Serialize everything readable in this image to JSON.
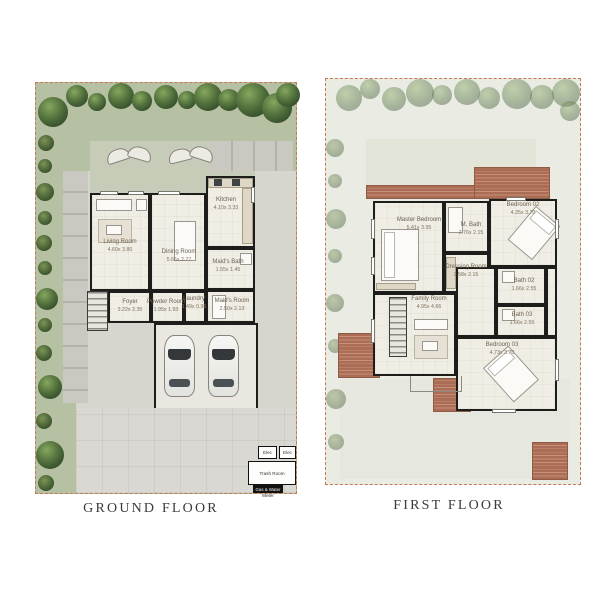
{
  "sheet": {
    "background": "#ffffff"
  },
  "colors": {
    "plan_border": "#c27a54",
    "garden": "#b6c0a2",
    "hardscape": "#d6d5ce",
    "walls": "#1d1d1b",
    "deck": "#ab6d56",
    "faded_background": "#eaece4"
  },
  "plans": [
    {
      "title": "GROUND FLOOR",
      "rooms": [
        {
          "name": "Living Room",
          "dims": "4.60x 3.80"
        },
        {
          "name": "Dining Room",
          "dims": "5.66x 2.77"
        },
        {
          "name": "Kitchen",
          "dims": "4.10x 3.33"
        },
        {
          "name": "Maid's Bath",
          "dims": "1.55x 1.45"
        },
        {
          "name": "Maid's Room",
          "dims": "2.50x 2.13"
        },
        {
          "name": "Foyer",
          "dims": "3.22x 2.35"
        },
        {
          "name": "Powder Room",
          "dims": "1.95x 1.93"
        },
        {
          "name": "Laundry",
          "dims": "1.49x 0.95"
        }
      ],
      "utility": {
        "elec1": "Elec",
        "elec2": "Elec",
        "trash": "Trash Room",
        "meter_line1": "Gas & Water",
        "meter_line2": "Meter"
      }
    },
    {
      "title": "FIRST FLOOR",
      "rooms": [
        {
          "name": "Master Bedroom",
          "dims": "5.41x 3.95"
        },
        {
          "name": "M. Bath",
          "dims": "2.76x 2.15"
        },
        {
          "name": "Dressing Room",
          "dims": "2.58x 2.15"
        },
        {
          "name": "Bedroom 02",
          "dims": "4.35x 3.70"
        },
        {
          "name": "Bath 02",
          "dims": "1.66x 2.55"
        },
        {
          "name": "Bath 03",
          "dims": "1.66x 2.55"
        },
        {
          "name": "Bedroom 03",
          "dims": "4.73x 3.70"
        },
        {
          "name": "Family Room",
          "dims": "4.95x 4.66"
        }
      ]
    }
  ]
}
